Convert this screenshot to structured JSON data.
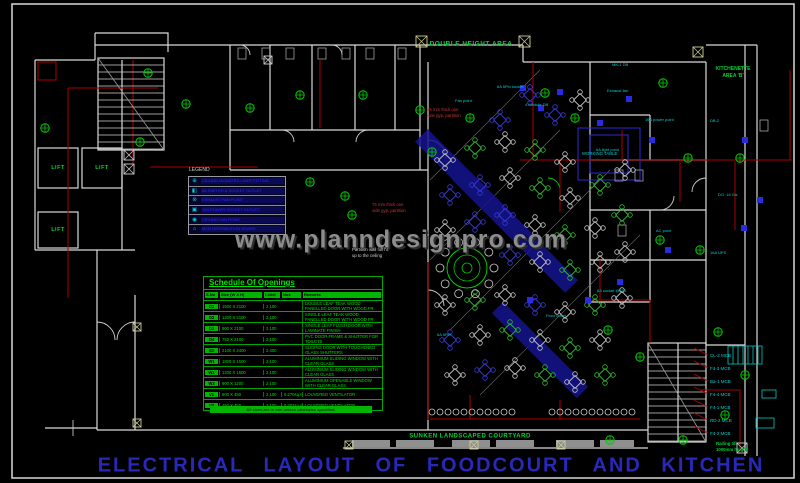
{
  "title": "ELECTRICAL LAYOUT OF FOODCOURT AND KITCHEN",
  "watermark": "www.planndesignpro.com",
  "labels": {
    "double_height_area": "DOUBLE HEIGHT AREA",
    "courtyard": "SUNKEN LANDSCAPED COURTYARD",
    "lift": "LIFT",
    "legend_title": "LEGEND",
    "kitchenette_1": "KITCHENETTE",
    "kitchenette_2": "AREA 'B'",
    "railing_1": "Railing till",
    "railing_2": "1000mm height",
    "note_red_1a": "75 mm thick one",
    "note_red_1b": "side gyp. partition",
    "note_red_2a": "75 mm thick one",
    "note_red_2b": "side gyp. partition",
    "note_wh_a": "Partition wall full ht.",
    "note_wh_b": "up to the ceiling",
    "working_table": "WORKING TABLE"
  },
  "schedule": {
    "title": "Schedule Of Openings",
    "headers": [
      "S.No",
      "Size (W X H)",
      "Lintel",
      "Nos",
      "Remarks"
    ],
    "rows": [
      [
        "D1",
        "1500 X 2100",
        "2.100",
        "",
        "DOUBLE LEAF TEAK WOOD PANELLED DOOR WITH WOOD FR."
      ],
      [
        "D2",
        "1200 X 2100",
        "2.100",
        "",
        "SINGLE LEAF TEAK WOOD PANELLED DOOR WITH WOOD FR."
      ],
      [
        "D3",
        "900 X 2100",
        "2.100",
        "",
        "SINGLE LEAF FLUSH DOOR WITH LAMINATE FINISH"
      ],
      [
        "D4",
        "750 X 2100",
        "2.100",
        "",
        "PVC DOOR FRAME & SHUTTER FOR TOILETS"
      ],
      [
        "SD",
        "2100 X 2400",
        "2.400",
        "",
        "SLIDING DOOR WITH TOUGHENED GLASS SHUTTERS"
      ],
      [
        "W1",
        "1800 X 1500",
        "2.100",
        "",
        "ALUMINIUM SLIDING WINDOW WITH CLEAR GLASS"
      ],
      [
        "W2",
        "1200 X 1500",
        "2.100",
        "",
        "ALUMINIUM SLIDING WINDOW WITH CLEAR GLASS"
      ],
      [
        "W3",
        "900 X 1200",
        "2.100",
        "",
        "ALUMINIUM OPENABLE WINDOW WITH CLEAR GLASS"
      ],
      [
        "V1",
        "600 X 450",
        "2.100",
        "0.270sq.m",
        "LOUVERED VENTILATOR"
      ],
      [
        "V2",
        "450 X 450",
        "2.100",
        "0.202sq.m",
        "LOUVERED VENTILATOR"
      ]
    ],
    "footer": "All sizes are in mm unless otherwise specified."
  },
  "legend": {
    "items": [
      {
        "sym": "⊕",
        "text": "CEILING MOUNTED LIGHT FITTING"
      },
      {
        "sym": "◧",
        "text": "5A SWITCH & SOCKET OUTLET"
      },
      {
        "sym": "⊗",
        "text": "EXHAUST FAN POINT"
      },
      {
        "sym": "▣",
        "text": "15A POWER SOCKET OUTLET"
      },
      {
        "sym": "◉",
        "text": "CEILING FAN POINT"
      },
      {
        "sym": "⌂",
        "text": "MCB DISTRIBUTION BOARD"
      }
    ]
  },
  "circuits": [
    "CL-2 MCB",
    "F4-3 MCB",
    "Ba-1 MCB",
    "F4-4 MCB",
    "F4-1 MCB",
    "RD-2 MCB",
    "F4-2 MCB"
  ],
  "annotations": [
    {
      "x": 497,
      "y": 84,
      "t": "6A 5Pin socket"
    },
    {
      "x": 525,
      "y": 102,
      "t": "4 Module DB"
    },
    {
      "x": 607,
      "y": 88,
      "t": "Exhaust fan"
    },
    {
      "x": 645,
      "y": 117,
      "t": "16A power point"
    },
    {
      "x": 596,
      "y": 147,
      "t": "6A light point"
    },
    {
      "x": 656,
      "y": 228,
      "t": "AC point"
    },
    {
      "x": 597,
      "y": 288,
      "t": "6A socket @450"
    },
    {
      "x": 546,
      "y": 313,
      "t": "Floor outlet"
    },
    {
      "x": 437,
      "y": 332,
      "t": "6A 5Pin"
    },
    {
      "x": 710,
      "y": 118,
      "t": "DB-2"
    },
    {
      "x": 718,
      "y": 192,
      "t": "DO. 16 Ga."
    },
    {
      "x": 710,
      "y": 250,
      "t": "16A UPS"
    },
    {
      "x": 455,
      "y": 98,
      "t": "Fan point"
    },
    {
      "x": 612,
      "y": 62,
      "t": "MK-1 DB"
    }
  ],
  "furniture": {
    "tables": [
      [
        445,
        160,
        "w"
      ],
      [
        475,
        148,
        "g"
      ],
      [
        505,
        142,
        "w"
      ],
      [
        535,
        150,
        "g"
      ],
      [
        565,
        162,
        "w"
      ],
      [
        500,
        120,
        "b"
      ],
      [
        530,
        95,
        "b"
      ],
      [
        555,
        115,
        "b"
      ],
      [
        580,
        100,
        "w"
      ],
      [
        450,
        195,
        "b"
      ],
      [
        480,
        185,
        "b"
      ],
      [
        510,
        178,
        "w"
      ],
      [
        540,
        188,
        "g"
      ],
      [
        570,
        198,
        "w"
      ],
      [
        600,
        185,
        "g"
      ],
      [
        625,
        170,
        "w"
      ],
      [
        445,
        230,
        "w"
      ],
      [
        475,
        222,
        "b"
      ],
      [
        505,
        215,
        "b"
      ],
      [
        535,
        225,
        "w"
      ],
      [
        565,
        235,
        "g"
      ],
      [
        595,
        228,
        "w"
      ],
      [
        622,
        215,
        "g"
      ],
      [
        510,
        255,
        "b"
      ],
      [
        540,
        262,
        "w"
      ],
      [
        570,
        270,
        "g"
      ],
      [
        600,
        262,
        "w"
      ],
      [
        625,
        252,
        "w"
      ],
      [
        445,
        305,
        "w"
      ],
      [
        475,
        300,
        "g"
      ],
      [
        505,
        295,
        "w"
      ],
      [
        535,
        305,
        "b"
      ],
      [
        565,
        312,
        "w"
      ],
      [
        595,
        305,
        "g"
      ],
      [
        622,
        298,
        "w"
      ],
      [
        450,
        340,
        "b"
      ],
      [
        480,
        335,
        "w"
      ],
      [
        510,
        330,
        "g"
      ],
      [
        540,
        340,
        "w"
      ],
      [
        570,
        348,
        "g"
      ],
      [
        600,
        340,
        "w"
      ],
      [
        455,
        375,
        "w"
      ],
      [
        485,
        370,
        "b"
      ],
      [
        515,
        368,
        "w"
      ],
      [
        545,
        375,
        "g"
      ],
      [
        575,
        382,
        "w"
      ],
      [
        605,
        375,
        "g"
      ]
    ],
    "lights": [
      [
        148,
        73
      ],
      [
        186,
        104
      ],
      [
        250,
        108
      ],
      [
        310,
        182
      ],
      [
        345,
        196
      ],
      [
        352,
        215
      ],
      [
        432,
        152
      ],
      [
        470,
        118
      ],
      [
        545,
        93
      ],
      [
        575,
        118
      ],
      [
        608,
        330
      ],
      [
        640,
        357
      ],
      [
        663,
        83
      ],
      [
        688,
        158
      ],
      [
        740,
        158
      ],
      [
        718,
        332
      ],
      [
        683,
        440
      ],
      [
        610,
        440
      ],
      [
        45,
        128
      ],
      [
        140,
        142
      ],
      [
        660,
        240
      ],
      [
        700,
        250
      ],
      [
        745,
        375
      ],
      [
        725,
        415
      ],
      [
        300,
        95
      ],
      [
        363,
        95
      ],
      [
        420,
        110
      ]
    ],
    "dbs": [
      [
        523,
        88
      ],
      [
        541,
        108
      ],
      [
        600,
        123
      ],
      [
        629,
        99
      ],
      [
        652,
        140
      ],
      [
        668,
        250
      ],
      [
        620,
        282
      ],
      [
        588,
        300
      ],
      [
        744,
        228
      ],
      [
        530,
        300
      ],
      [
        560,
        92
      ],
      [
        745,
        140
      ],
      [
        760,
        200
      ]
    ],
    "counters": [
      {
        "x": 432,
        "y": 412,
        "n": 11,
        "s": 8
      },
      {
        "x": 552,
        "y": 412,
        "n": 11,
        "s": 8
      }
    ],
    "round_table": {
      "x": 467,
      "y": 268,
      "chairs": 10
    }
  },
  "stairs": [
    {
      "x": 98,
      "y": 58,
      "w": 66,
      "h": 92,
      "step": 7
    },
    {
      "x": 648,
      "y": 343,
      "w": 58,
      "h": 99,
      "step": 7
    }
  ],
  "xboxes": [
    [
      124,
      150,
      10,
      "w"
    ],
    [
      124,
      164,
      10,
      "w"
    ],
    [
      416,
      36,
      11,
      "y"
    ],
    [
      519,
      36,
      11,
      "y"
    ],
    [
      693,
      47,
      10,
      "y"
    ],
    [
      133,
      323,
      8,
      "y"
    ],
    [
      133,
      419,
      8,
      "y"
    ],
    [
      345,
      441,
      8,
      "y"
    ],
    [
      470,
      441,
      8,
      "y"
    ],
    [
      557,
      441,
      8,
      "y"
    ],
    [
      737,
      443,
      10,
      "w"
    ],
    [
      264,
      56,
      8,
      "w"
    ]
  ],
  "fixtures": [
    [
      238,
      48
    ],
    [
      262,
      48
    ],
    [
      286,
      48
    ],
    [
      318,
      48
    ],
    [
      342,
      48
    ],
    [
      366,
      48
    ],
    [
      398,
      48
    ],
    [
      615,
      170
    ],
    [
      635,
      170
    ],
    [
      618,
      225
    ],
    [
      760,
      120
    ]
  ],
  "colors": {
    "wall": "#d9d9d9",
    "green": "#00cc00",
    "cyan": "#00c8c8",
    "red": "#ad0000",
    "blue": "#2a2ae0",
    "band": "#14148f",
    "table_w": "#c8c8c8",
    "table_b": "#3b3bde",
    "table_g": "#2fbf2f",
    "column_y": "#cfcf96"
  }
}
